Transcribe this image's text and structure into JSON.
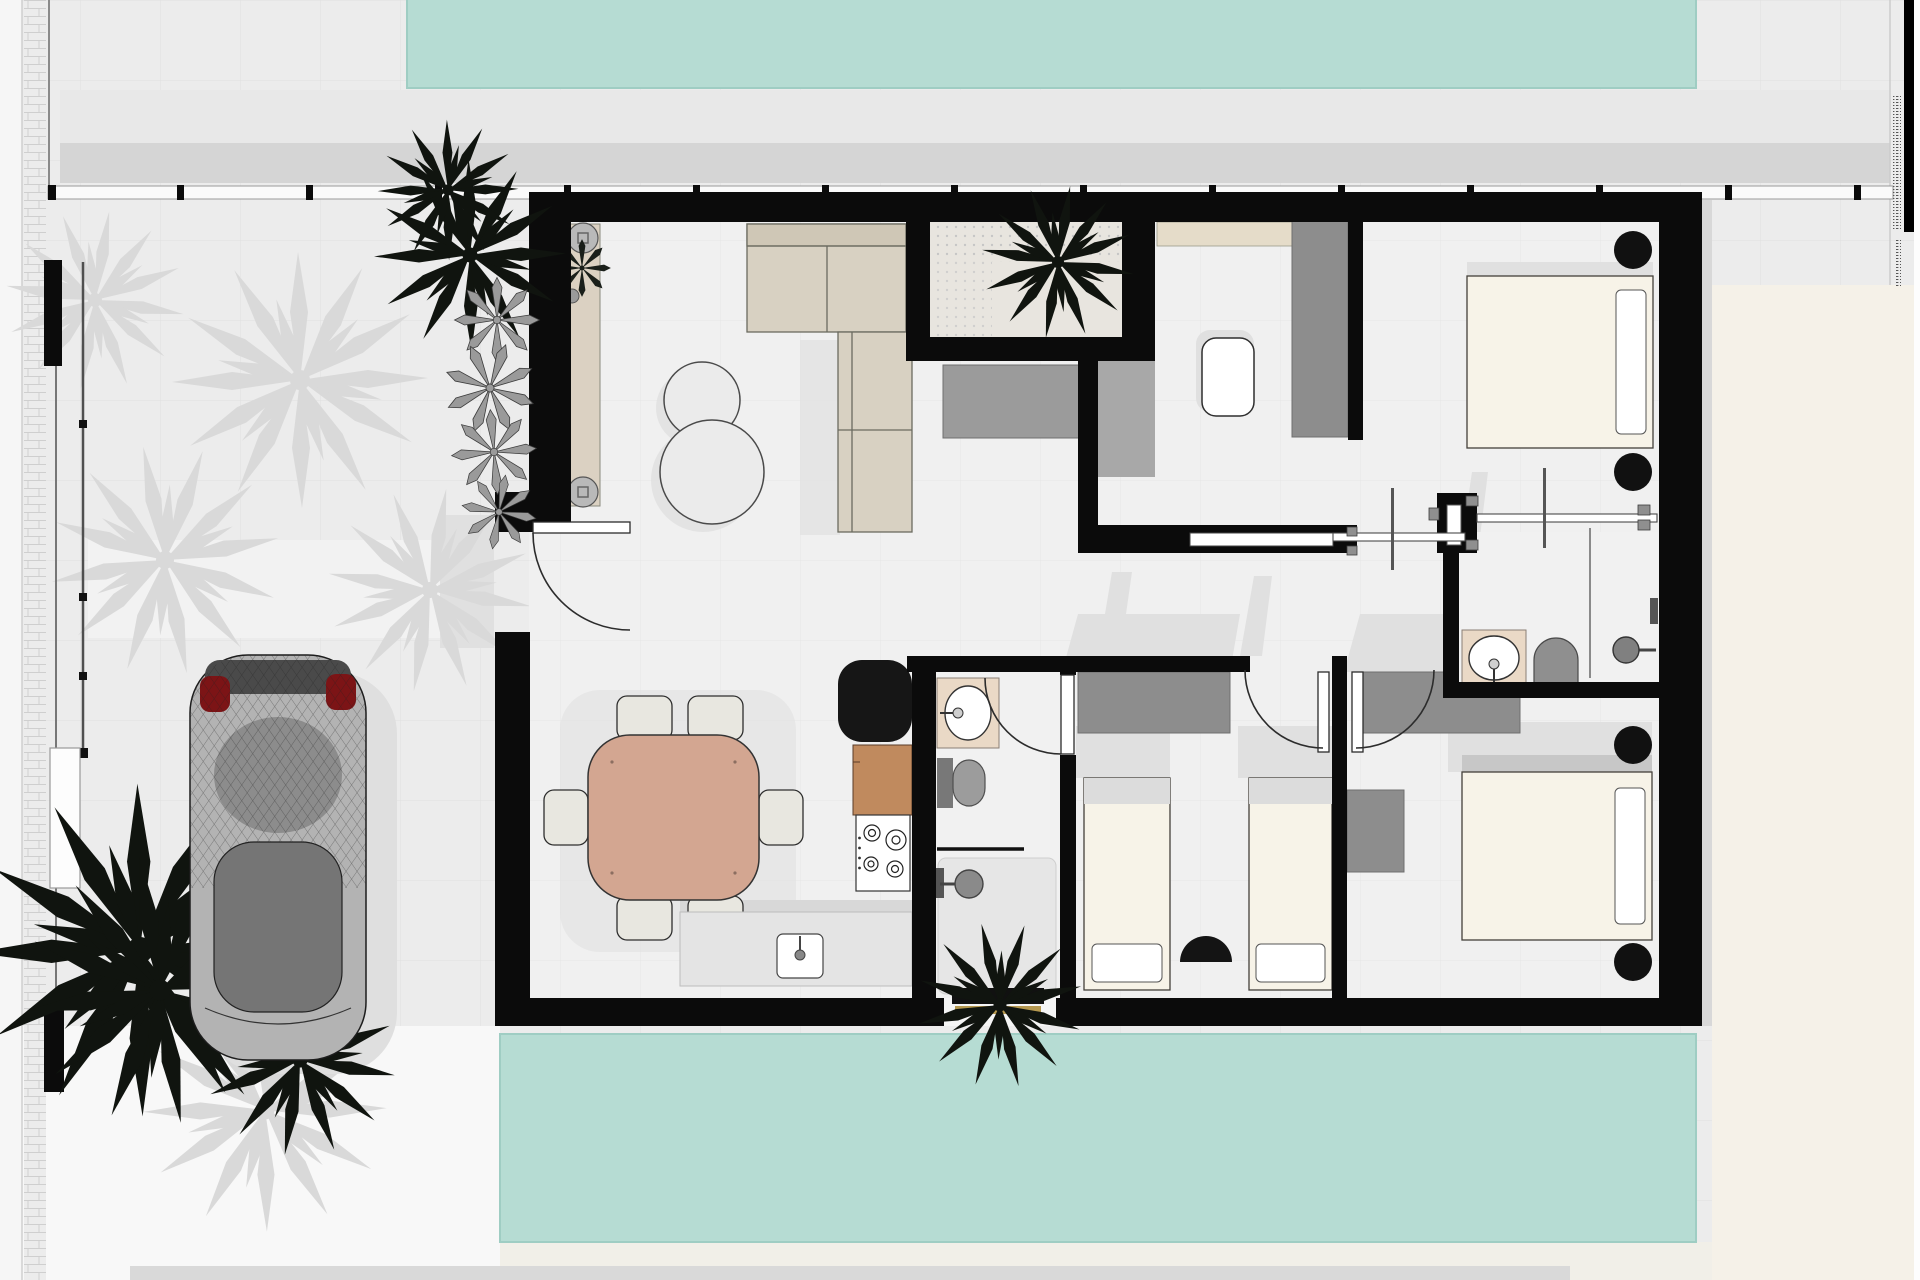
{
  "document": {
    "type": "architectural-floor-plan",
    "view": "top-down-3d-render",
    "legible_text": false,
    "right_margin": {
      "black_title_bar": true,
      "micro_text_illegible": true
    }
  },
  "colors": {
    "outdoor_floor": "#ececec",
    "indoor_floor": "#f0f0f0",
    "pool_teal": "#b6dcd3",
    "pool_edge": "#9fcdc3",
    "terrace_band": "#d5d5d5",
    "terrace_band_light": "#e8e8e8",
    "cream_ground": "#f5f1e8",
    "wall_black": "#0b0b0b",
    "sofa_beige": "#d8d1c2",
    "console_beige": "#dbd1c2",
    "dining_wood": "#d3a691",
    "chair_fabric": "#e8e7e0",
    "bed_cream": "#f7f3e8",
    "pillow_white": "#ffffff",
    "headboard_gray": "#c7c7c7",
    "wardrobe_gray": "#8d8d8d",
    "counter_wood": "#c08a5e",
    "appliance_black": "#161616",
    "bath_counter_beige": "#ead9c6",
    "fixture_gray": "#9c9c9c",
    "plant_dark": "#10140f",
    "plant_shadow": "#d9d9d9",
    "agave_gray": "#9a9a9a",
    "car_body_gray": "#b3b3b3",
    "car_glass_gray": "#757575",
    "tail_light_red": "#7c1416",
    "shadow_light": "#e0e0e0"
  },
  "rooms": [
    {
      "name": "living-dining-kitchen",
      "furniture": [
        "l-shaped-sofa",
        "round-coffee-tables",
        "entry-console-with-planters",
        "dining-table-six-chairs",
        "refrigerator",
        "wood-counter",
        "cooktop-four-burners",
        "sink-counter"
      ]
    },
    {
      "name": "inner-patio",
      "furniture": [
        "palm-plant",
        "gravel-bed",
        "media-sideboard"
      ]
    },
    {
      "name": "guest-bathroom",
      "furniture": [
        "washbasin",
        "toilet",
        "shower",
        "towel-bar",
        "window-planter-palm"
      ]
    },
    {
      "name": "office",
      "furniture": [
        "wall-shelf",
        "tall-wardrobe",
        "white-desk"
      ]
    },
    {
      "name": "hallway",
      "furniture": [
        "pocket-sliding-doors"
      ]
    },
    {
      "name": "bedroom-top-right",
      "furniture": [
        "double-bed",
        "side-pillow",
        "round-bedside-tables"
      ]
    },
    {
      "name": "bedroom-twin",
      "furniture": [
        "wardrobe",
        "twin-bed-left",
        "twin-bed-right",
        "dark-pouf"
      ]
    },
    {
      "name": "master-bedroom",
      "furniture": [
        "wardrobe",
        "dresser",
        "double-bed",
        "round-bedside-tables"
      ]
    },
    {
      "name": "ensuite-bathroom",
      "furniture": [
        "washbasin",
        "toilet",
        "walk-in-shower",
        "glass-panel"
      ]
    }
  ],
  "exterior": {
    "features": [
      "swimming-pool-top",
      "swimming-pool-bottom",
      "upper-terrace-band",
      "terrace-railing-with-posts",
      "left-perimeter-fence",
      "tiled-walkway-strip",
      "driveway-parked-car",
      "dark-palm-trees",
      "light-palm-shadows",
      "agave-row",
      "entry-step",
      "white-planter-box"
    ]
  }
}
